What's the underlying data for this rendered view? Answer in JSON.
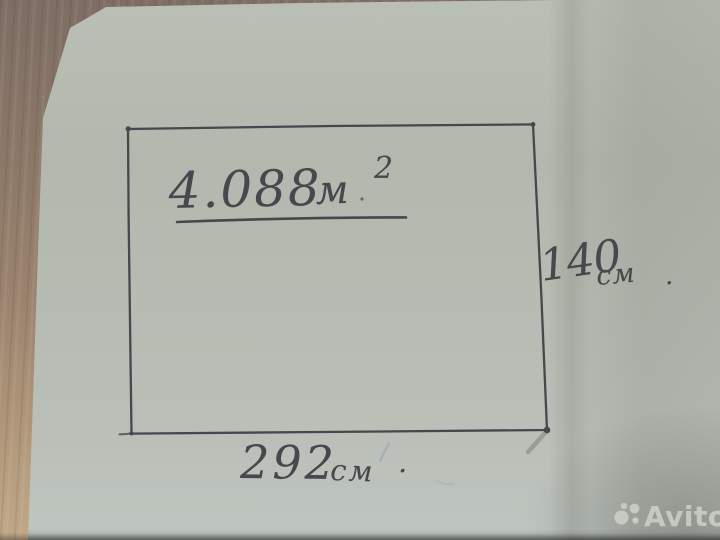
{
  "sketch": {
    "area": {
      "number": "4.088",
      "unit": "м",
      "exponent": "2"
    },
    "height": {
      "number": "140",
      "unit": "см",
      "period": "."
    },
    "width": {
      "number": "292",
      "unit": "см",
      "period": "."
    }
  },
  "watermark": {
    "brand": "Avito"
  },
  "colors": {
    "ink": "#45484c",
    "paper": "#b3b8ae",
    "floor": "#97816d",
    "blue_pen": "#8b95c2",
    "watermark_text": "#cbd1c8"
  }
}
